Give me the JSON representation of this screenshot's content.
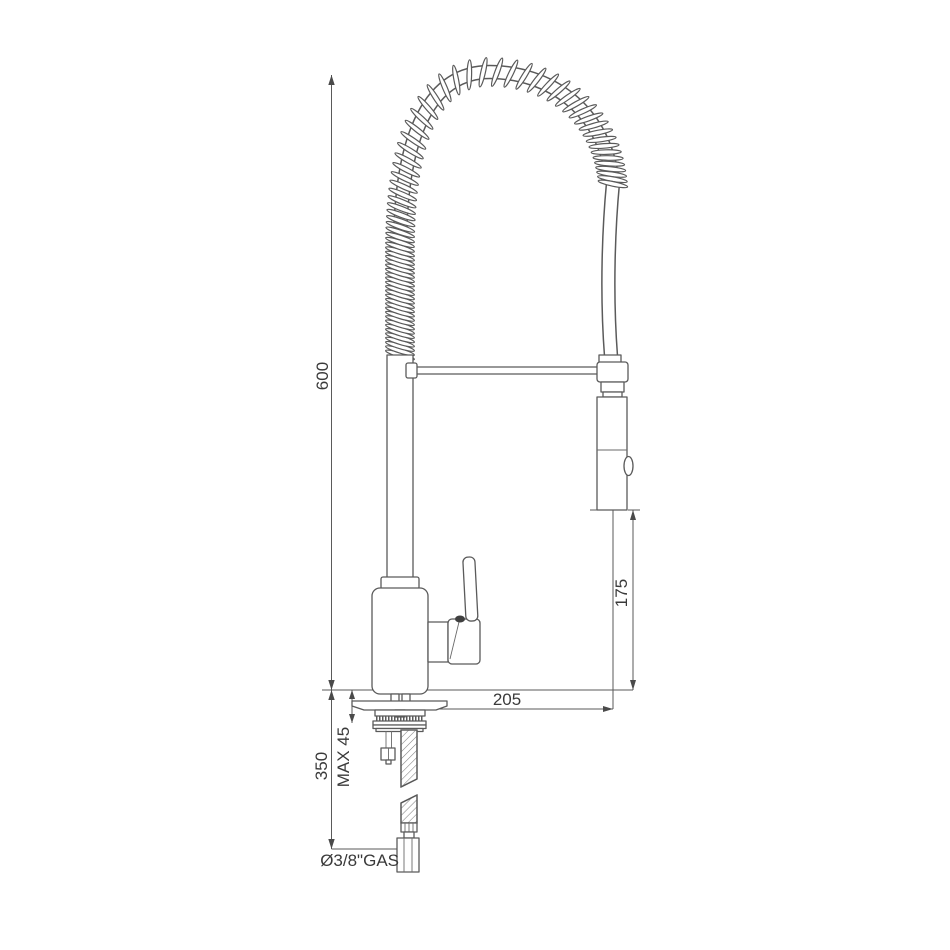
{
  "drawing": {
    "title": "spring-spout-faucet-technical-drawing",
    "labels": {
      "overall_height": "600",
      "head_to_deck": "175",
      "spout_reach": "205",
      "under_deck_hose": "350",
      "deck_thickness": "MAX 45",
      "connection_size": "Ø3/8\"GAS"
    },
    "colors": {
      "line": "#5a5a5a",
      "text": "#3a3a3a",
      "background": "#ffffff"
    }
  }
}
